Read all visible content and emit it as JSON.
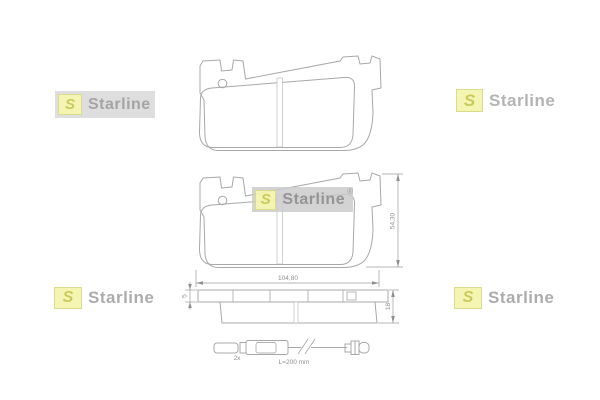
{
  "product_image": {
    "type": "brake-pad-set-technical-drawing",
    "background": "#ffffff"
  },
  "brand": {
    "name": "Starline",
    "logo_letter": "S",
    "registered_mark": "®",
    "colors": {
      "logo_square_bg": "#f5f5ad",
      "logo_square_border": "#d9d983",
      "logo_letter_color": "#c6c64e",
      "logo_text_color": "#a6a6a6",
      "watermark_box_bg": "#dcdcdc"
    }
  },
  "dimensions": {
    "pad_width": "104,80",
    "pad_height": "54,30",
    "backplate_thickness": "5",
    "total_thickness": "18"
  },
  "wear_sensor": {
    "quantity": "2x",
    "length": "L=200 mm"
  },
  "drawing": {
    "line_color": "#a8a8a8",
    "views": [
      "front-view-plain",
      "front-view-dimensioned",
      "side-view",
      "wear-sensor"
    ]
  }
}
